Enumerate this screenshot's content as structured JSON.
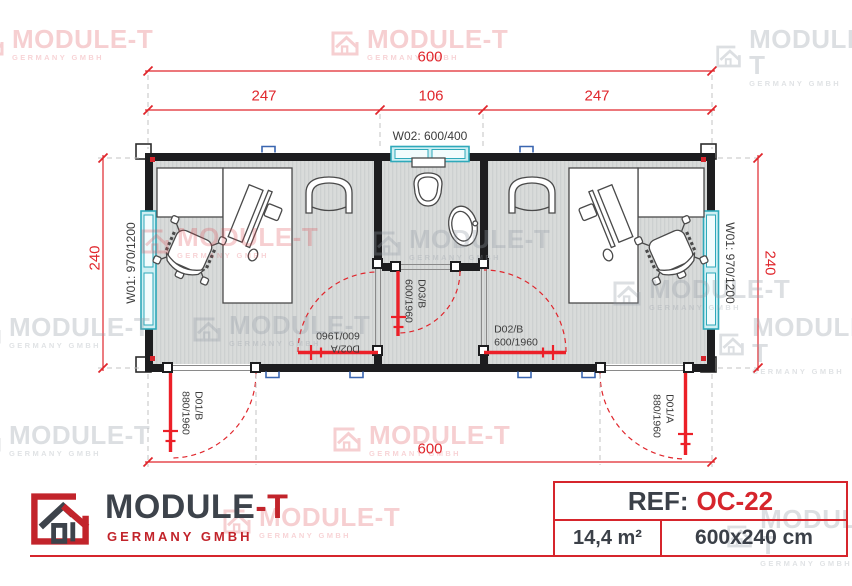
{
  "colors": {
    "accent_red": "#d6252c",
    "dimension_red": "#e0262c",
    "door_red": "#ec2028",
    "wall_black": "#1d1d1f",
    "window_teal": "#2fa9ba",
    "floor_gray": "#d9dbda"
  },
  "dimensions": {
    "top_total": "600",
    "top_left": "247",
    "top_middle": "106",
    "top_right": "247",
    "bottom_total": "600",
    "side_left": "240",
    "side_right": "240"
  },
  "windows": {
    "left": "W01: 970/1200",
    "right": "W01: 970/1200",
    "top": "W02: 600/400"
  },
  "doors": {
    "d01b": {
      "code": "D01/B",
      "size": "880/1960"
    },
    "d01a": {
      "code": "D01/A",
      "size": "880/1960"
    },
    "d02a": {
      "code": "D02/A",
      "size": "600/1960"
    },
    "d02b": {
      "code": "D02/B",
      "size": "600/1960"
    },
    "d03b": {
      "code": "D03/B",
      "size": "600/1960"
    }
  },
  "brand": {
    "name_main": "MODULE",
    "name_accent": "-T",
    "subtitle": "GERMANY GMBH"
  },
  "ref_box": {
    "label": "REF:",
    "code": "OC-22",
    "area": "14,4 m²",
    "size": "600x240 cm"
  },
  "watermark": {
    "title": "MODULE-T",
    "subtitle": "GERMANY GMBH"
  }
}
